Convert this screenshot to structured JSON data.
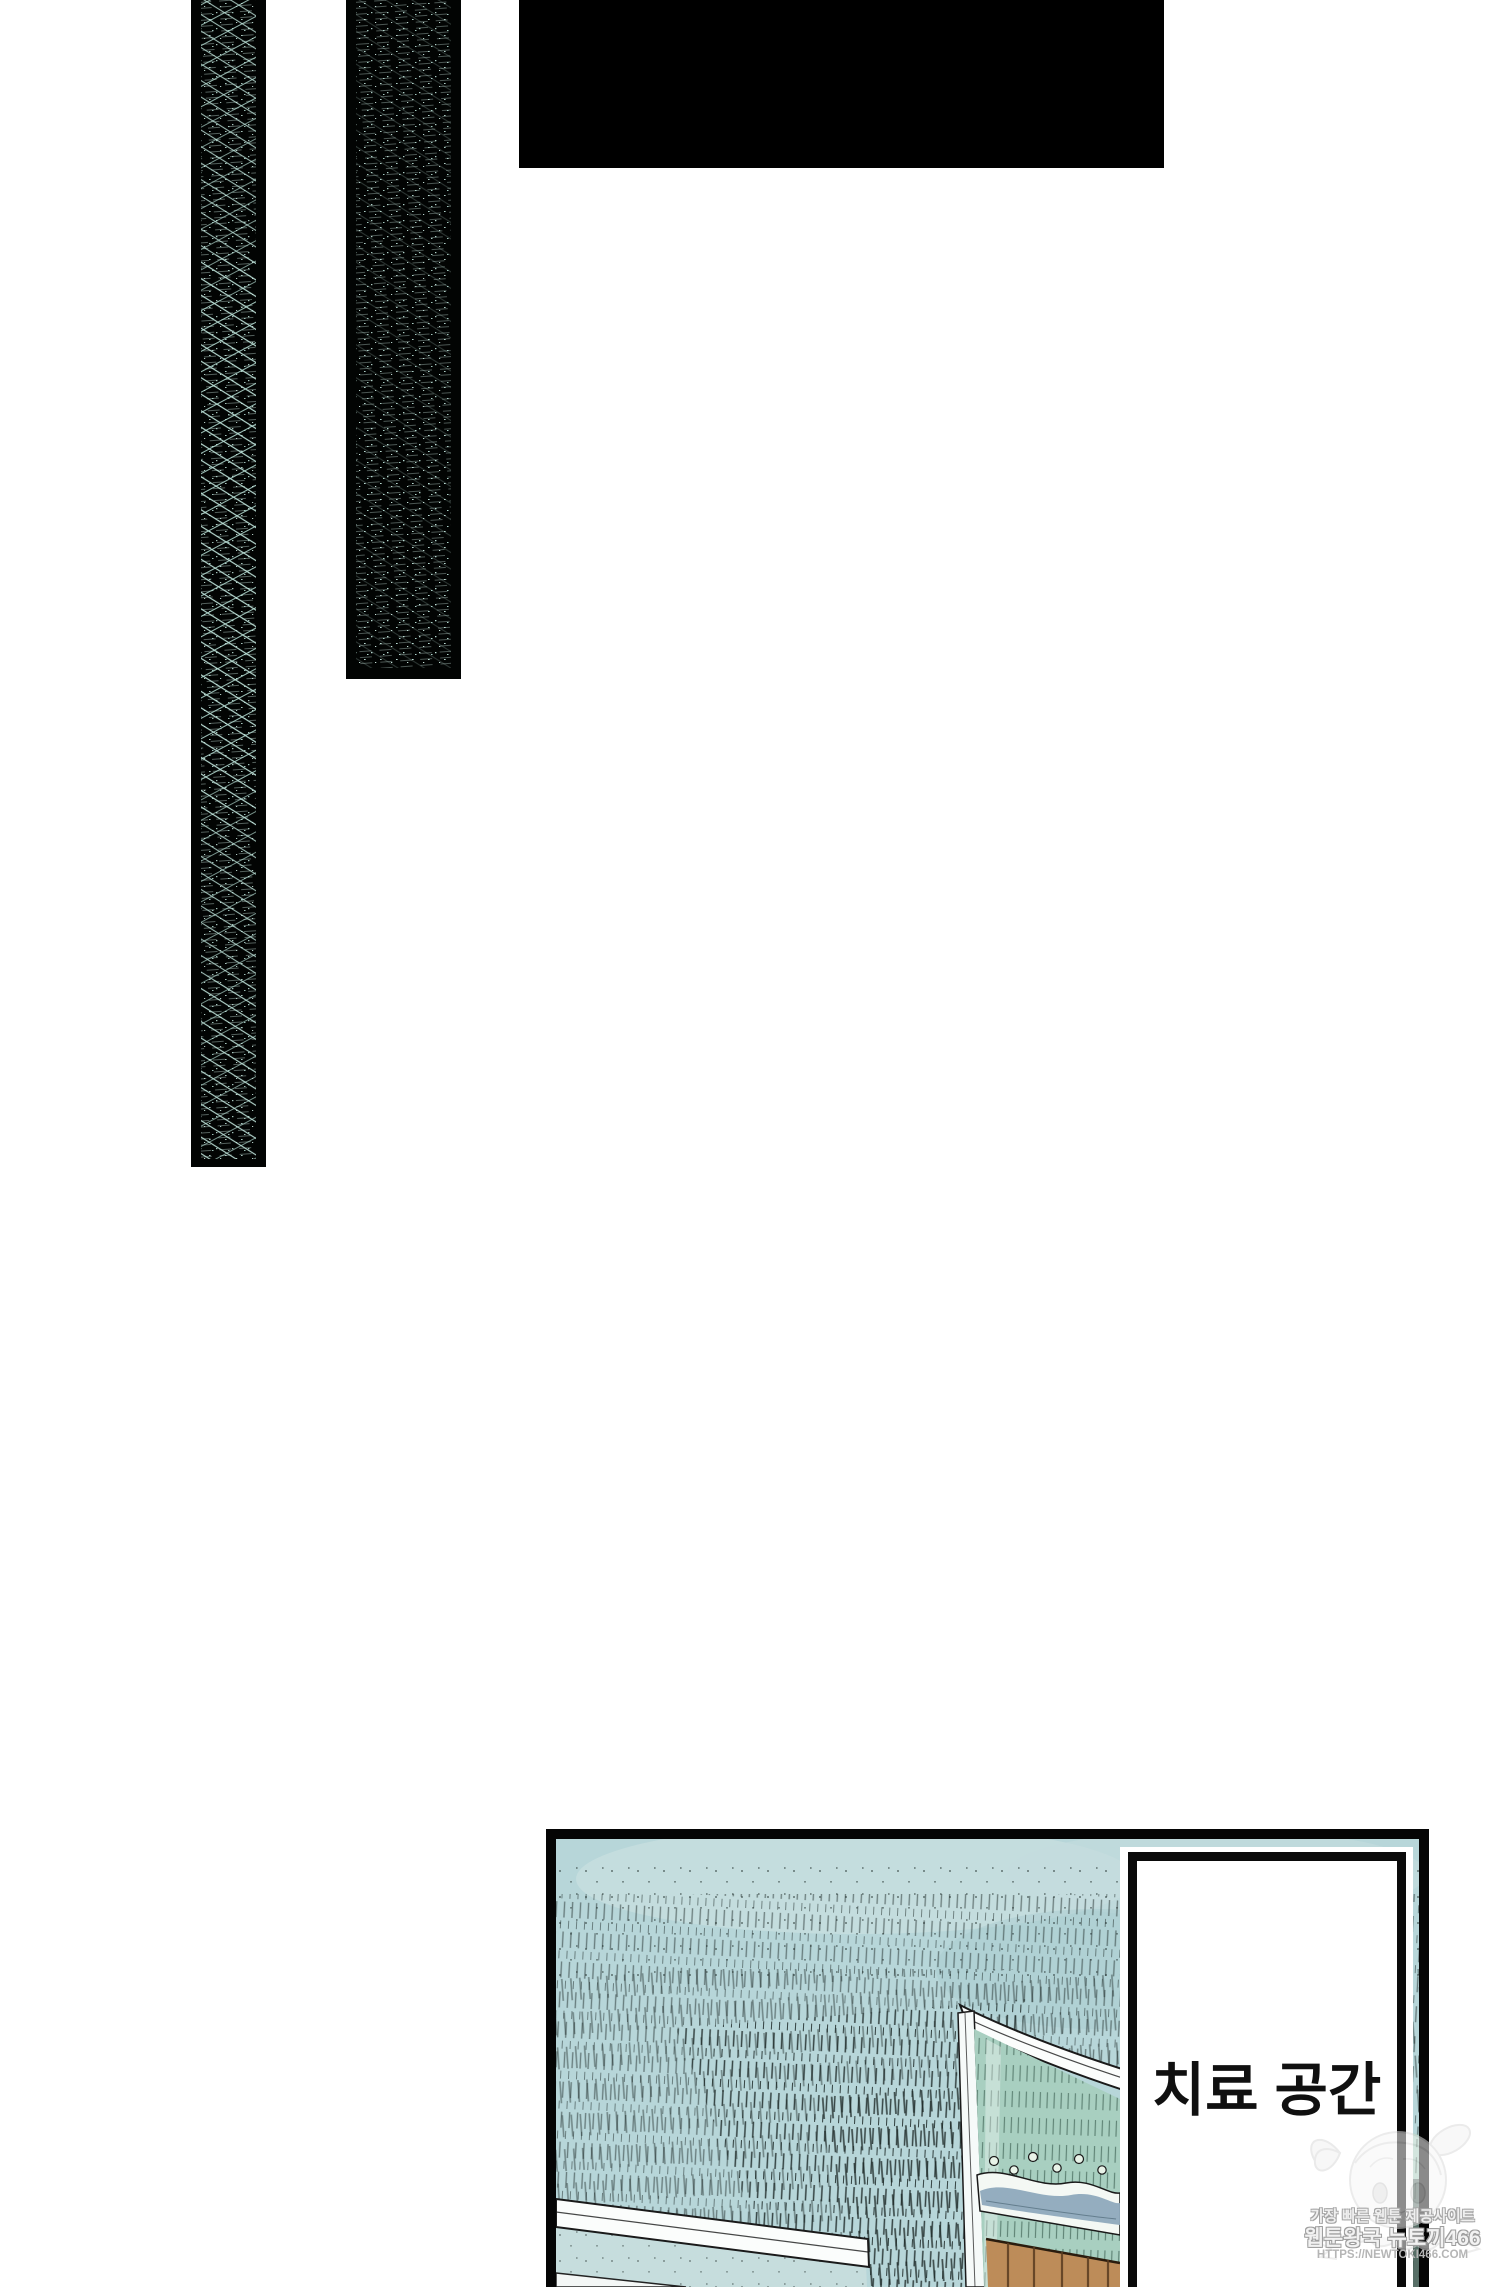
{
  "page": {
    "kind": "webtoon episode page (vertical scroll comic)",
    "background": "#ffffff"
  },
  "caption": {
    "text": "치료 공간"
  },
  "watermark": {
    "line1": "가장 빠른 웹툰 제공사이트",
    "line2": "웹툰왕국 뉴토끼466",
    "line3": "HTTPS://NEWTOKI466.COM"
  },
  "colors": {
    "ink_black": "#020403",
    "strip_texture_mint": "#bfe3da",
    "ceiling_teal": "#b7d6d9",
    "ceiling_hatch": "#1c2826",
    "wall_light_blue": "#c6dddd",
    "molding_white": "#fbfdfc",
    "green_wall": "#a8cfc0",
    "wave_trim_blue": "#8ea9bc",
    "wood_brown": "#bd8c59",
    "wood_grain": "#5a3c20",
    "caption_ink": "#101010",
    "watermark_grey": "#b5b5b5"
  }
}
